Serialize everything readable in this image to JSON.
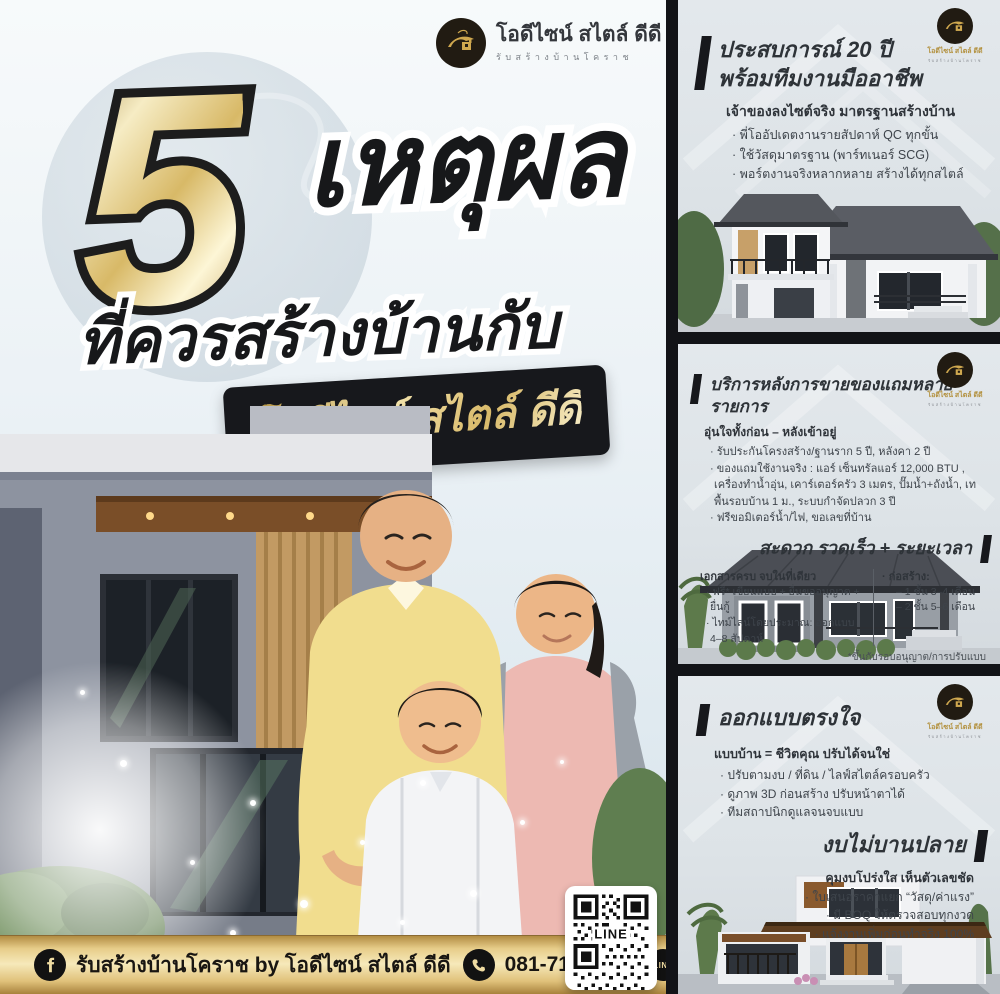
{
  "colors": {
    "gold": "#d8b261",
    "gold_light": "#f4e6b6",
    "dark": "#17181c",
    "card_bg": "#dfe4e8",
    "text_dark": "#2e3338",
    "text_body": "#3e444b",
    "footer_gold": "#e7cd8a"
  },
  "logo": {
    "name": "โอดีไซน์ สไตล์ ดีดี",
    "tagline": "รับสร้างบ้านโคราช"
  },
  "hero": {
    "number": "5",
    "headline": "เหตุผล",
    "subheadline": "ที่ควรสร้างบ้านกับ",
    "badge": "โอดีไซน์ สไตล์ ดีดี"
  },
  "cards": [
    {
      "title_line1": "ประสบการณ์ 20 ปี",
      "title_line2": "พร้อมทีมงานมืออาชีพ",
      "subheading": "เจ้าของลงไซต์จริง มาตรฐานสร้างบ้าน",
      "bullets": [
        "· พี่โออัปเดตงานรายสัปดาห์ QC ทุกขั้น",
        "· ใช้วัสดุมาตรฐาน (พาร์ทเนอร์ SCG)",
        "· พอร์ตงานจริงหลากหลาย สร้างได้ทุกสไตล์"
      ]
    },
    {
      "title": "บริการหลังการขายของแถมหลายรายการ",
      "subheading": "อุ่นใจทั้งก่อน – หลังเข้าอยู่",
      "bullets": [
        "· รับประกันโครงสร้าง/ฐานราก 5 ปี, หลังคา 2 ปี",
        "· ของแถมใช้งานจริง : แอร์ เซ็นทรัลแอร์ 12,000 BTU , เครื่องทำน้ำอุ่น, เคาร์เตอร์ครัว 3 เมตร, ปั๊มน้ำ+ถังน้ำ, เทพื้นรอบบ้าน 1 ม., ระบบกำจัดปลวก 3 ปี",
        "· ฟรีขอมิเตอร์น้ำ/ไฟ, ขอเลขที่บ้าน"
      ],
      "section2": {
        "title": "สะดวก รวดเร็ว + ระยะเวลา",
        "left_heading": "เอกสารครบ จบในที่เดียว",
        "left_bullets": [
          "· ฟรี* เขียนแบบ + ยื่นขออนุญาต + ยื่นกู้",
          "· ไทม์ไลน์โดยประมาณ: ออกแบบ 4–8 สัปดาห์"
        ],
        "right_heading": "· ก่อสร้าง:",
        "right_bullets": [
          "– 1 ชั้น 3–4 เดือน",
          "– 2 ชั้น 5–6 เดือน"
        ],
        "footnote": "*ขึ้นกับรอบอนุญาต/การปรับแบบ"
      }
    },
    {
      "title": "ออกแบบตรงใจ",
      "subheading": "แบบบ้าน = ชีวิตคุณ ปรับได้จนใช่",
      "bullets": [
        "· ปรับตามงบ / ที่ดิน / ไลฟ์สไตล์ครอบครัว",
        "· ดูภาพ 3D ก่อนสร้าง ปรับหน้าตาได้",
        "· ทีมสถาปนิกดูแลจนจบแบบ"
      ],
      "section2": {
        "title": "งบไม่บานปลาย",
        "subheading": "คุมงบโปร่งใส เห็นตัวเลขชัด",
        "bullets": [
          "· ใบเสนอราคาแยก “วัสดุ/ค่าแรง”",
          "· มี BOQ ให้ตรวจสอบทุกงวด",
          "· แจ้งงานเพิ่มก่อนทำจริง 100%"
        ]
      }
    }
  ],
  "footer": {
    "facebook_label": "รับสร้างบ้านโคราช by โอดีไซน์ สไตล์ ดีดี",
    "phone": "081-718-6671",
    "line_id": "@odesign",
    "line_icon_label": "LINE"
  },
  "qr": {
    "label": "LINE"
  }
}
